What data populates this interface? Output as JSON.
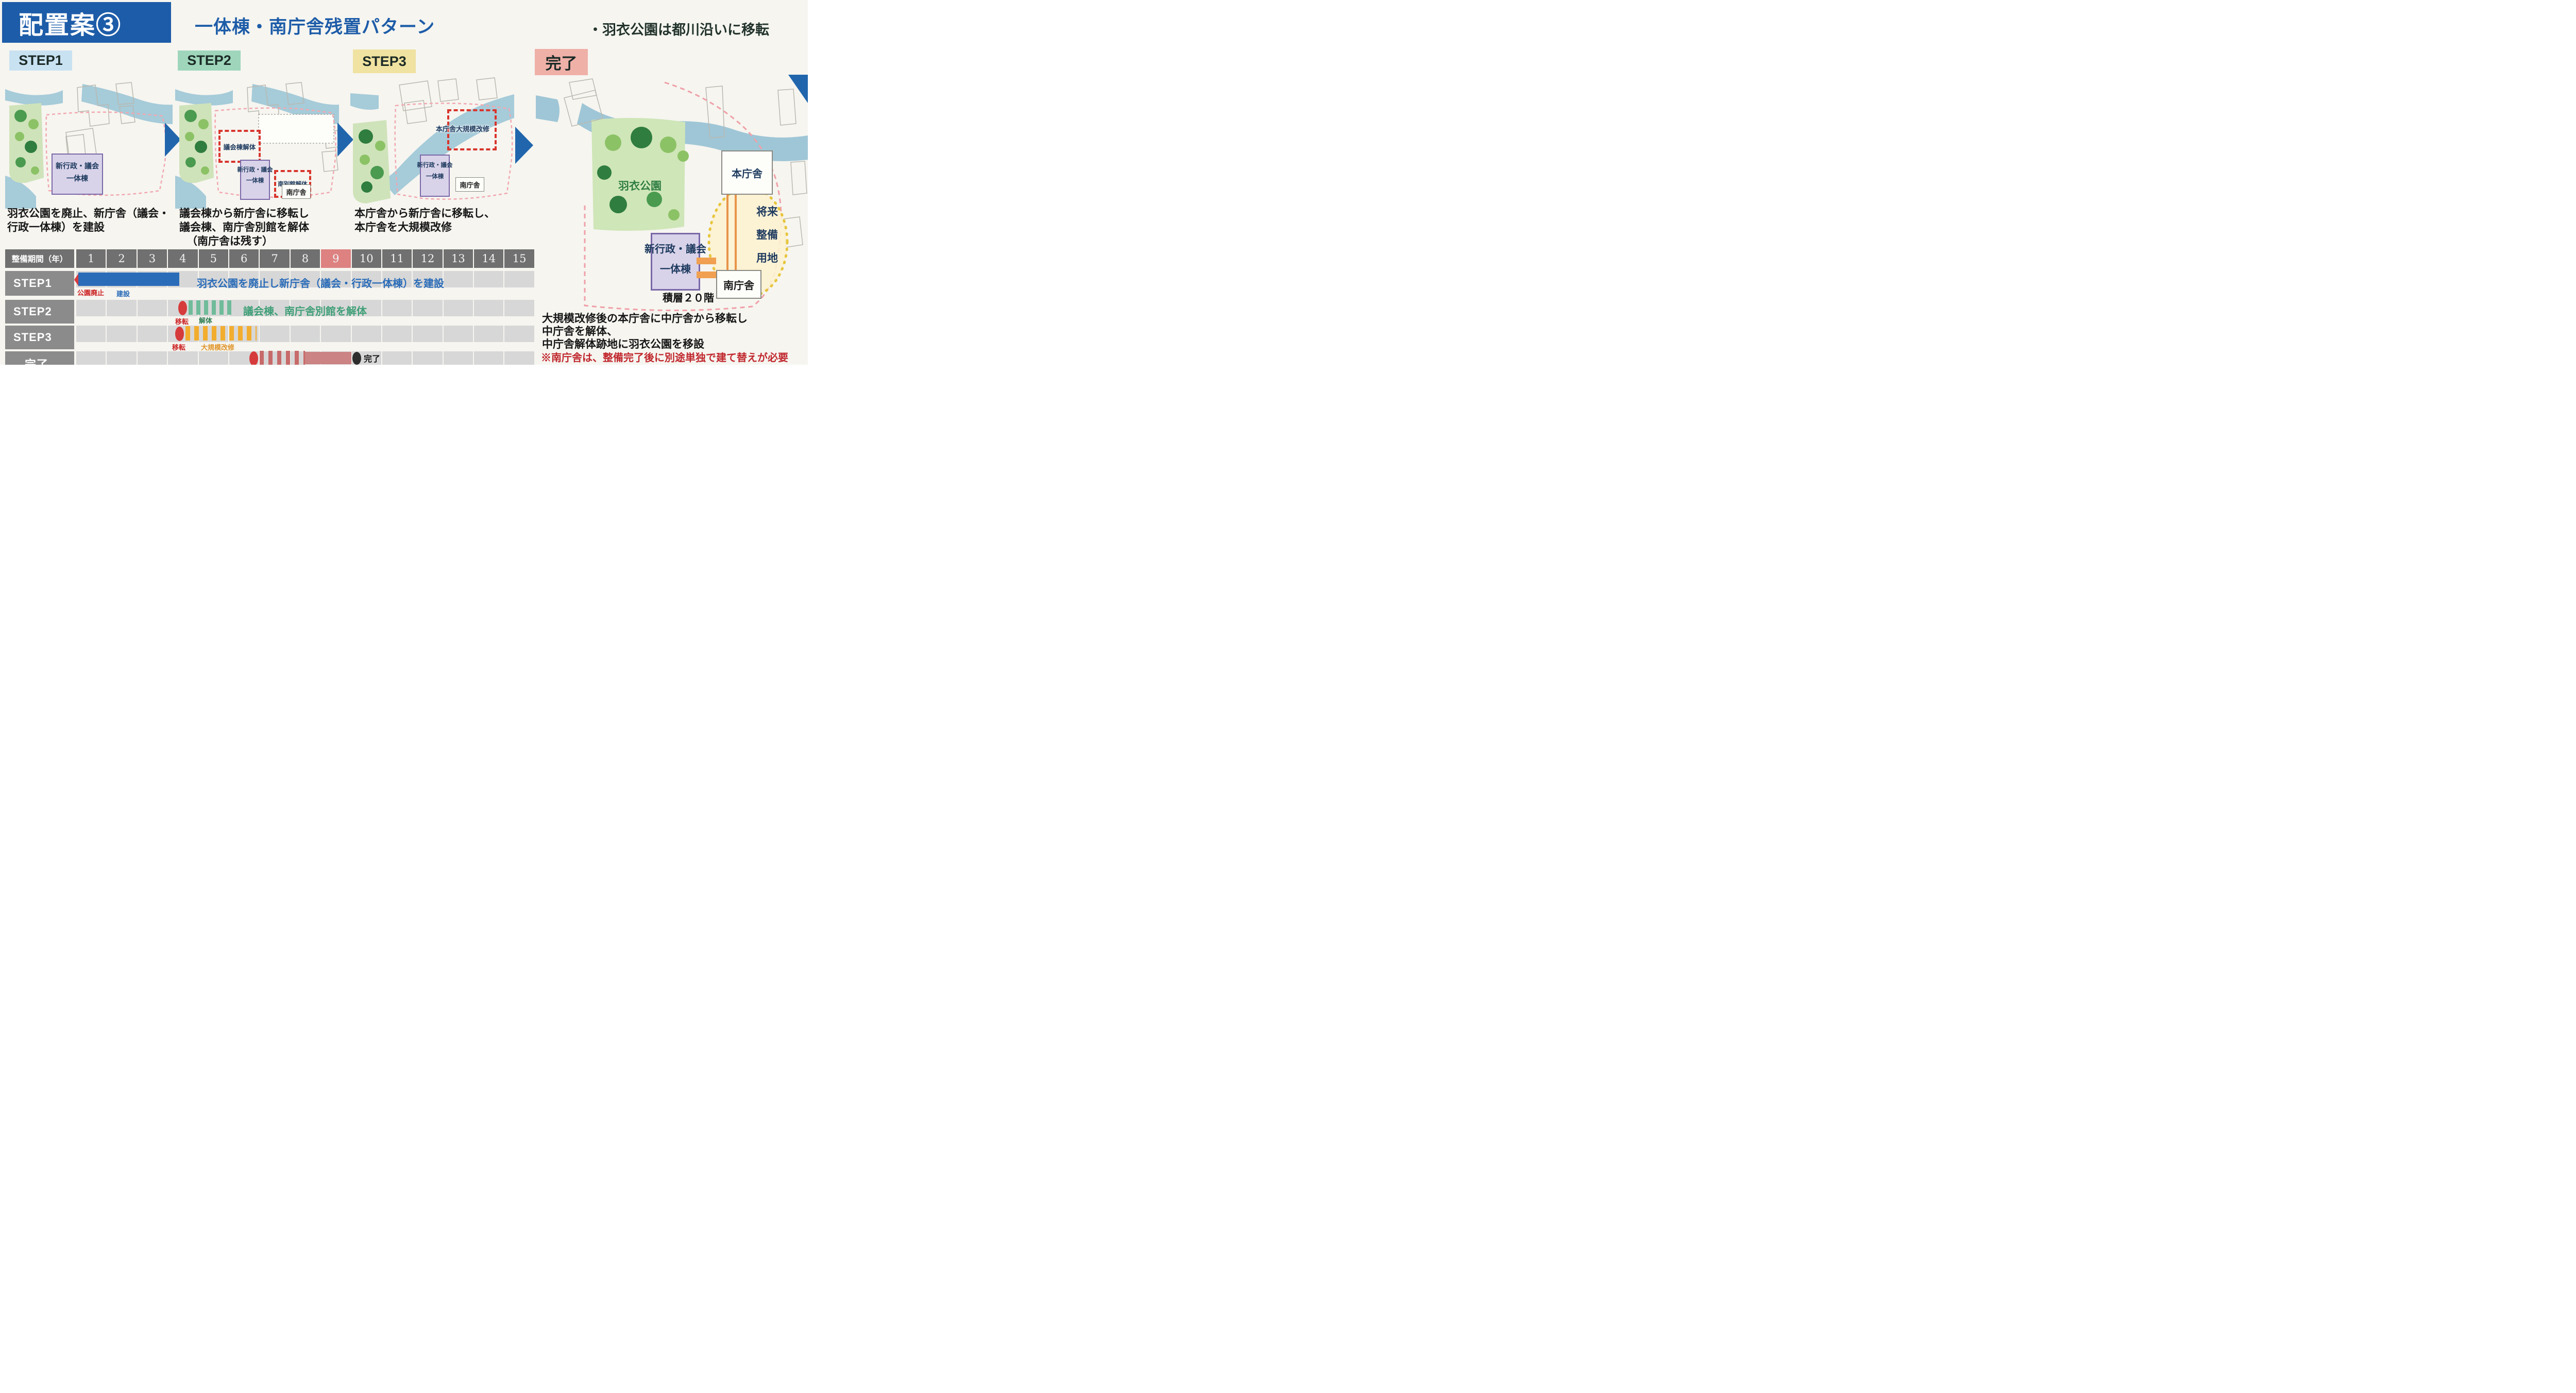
{
  "header": {
    "title": "配置案③",
    "subtitle": "一体棟・南庁舎残置パターン",
    "note": "・羽衣公園は都川沿いに移転"
  },
  "panels": {
    "step1": {
      "label": "STEP1",
      "building_line1": "新行政・議会",
      "building_line2": "一体棟",
      "desc_line1": "羽衣公園を廃止、新庁舎（議会・",
      "desc_line2": "行政一体棟）を建設"
    },
    "step2": {
      "label": "STEP2",
      "demolish_box": "議会棟解体",
      "building_line1": "新行政・議会",
      "building_line2": "一体棟",
      "annex_box": "南別館解体",
      "south_hall": "南庁舎",
      "desc_line1": "議会棟から新庁舎に移転し",
      "desc_line2": "議会棟、南庁舎別館を解体",
      "desc_line3": "（南庁舎は残す）"
    },
    "step3": {
      "label": "STEP3",
      "renovation_box": "本庁舎大規模改修",
      "building_line1": "新行政・議会",
      "building_line2": "一体棟",
      "south_hall": "南庁舎",
      "desc_line1": "本庁舎から新庁舎に移転し、",
      "desc_line2": "本庁舎を大規模改修"
    },
    "final": {
      "label": "完了",
      "main_hall": "本庁舎",
      "park": "羽衣公園",
      "future_line1": "将来",
      "future_line2": "整備",
      "future_line3": "用地",
      "building_line1": "新行政・議会",
      "building_line2": "一体棟",
      "floors": "積層２０階",
      "south_hall": "南庁舎",
      "note_line1": "大規模改修後の本庁舎に中庁舎から移転し",
      "note_line2": "中庁舎を解体、",
      "note_line3": "中庁舎解体跡地に羽衣公園を移設",
      "note_warning": "※南庁舎は、整備完了後に別途単独で建て替えが必要"
    }
  },
  "gantt": {
    "header_label": "整備期間（年）",
    "years": [
      "1",
      "2",
      "3",
      "4",
      "5",
      "6",
      "7",
      "8",
      "9",
      "10",
      "11",
      "12",
      "13",
      "14",
      "15"
    ],
    "highlighted_year": "9",
    "rows": [
      {
        "label": "STEP1",
        "start_label": "公園廃止",
        "bar_label": "建設",
        "description": "羽衣公園を廃止し新庁舎（議会・行政一体棟）を建設",
        "bar_style": "solid-blue",
        "bar_start_year": 1,
        "bar_end_year": 4.3
      },
      {
        "label": "STEP2",
        "start_label": "移転",
        "bar_label": "解体",
        "description": "議会棟、南庁舎別館を解体",
        "bar_style": "striped-green",
        "bar_start_year": 4.5,
        "bar_end_year": 6.1
      },
      {
        "label": "STEP3",
        "start_label": "移転",
        "bar_label": "大規模改修",
        "description": "",
        "bar_style": "striped-orange",
        "bar_start_year": 4.4,
        "bar_end_year": 6.8
      },
      {
        "label": "完了",
        "start_label": "移転",
        "bar_label": "中庁舎解体、デッキ整備、羽衣公園移転",
        "end_label": "完了",
        "bar_style": "striped-red",
        "bar_start_year": 6.9,
        "bar_end_year": 9
      }
    ]
  },
  "colors": {
    "accent_blue": "#1d5ca8",
    "step1_bg": "#c9e2f2",
    "step2_bg": "#9fd6bb",
    "step3_bg": "#f0e2a0",
    "final_bg": "#efb0a8",
    "bar_blue": "#2b6cb8",
    "bar_green": "#6fbb9a",
    "bar_orange": "#f2ad2e",
    "bar_red": "#c76a6a",
    "marker_red": "#d63b3b",
    "highlight_year_red": "#dd8181",
    "purple_building": "#d9d3ea",
    "park_green": "#cfe6b8",
    "river_blue": "#a3c9d9"
  }
}
